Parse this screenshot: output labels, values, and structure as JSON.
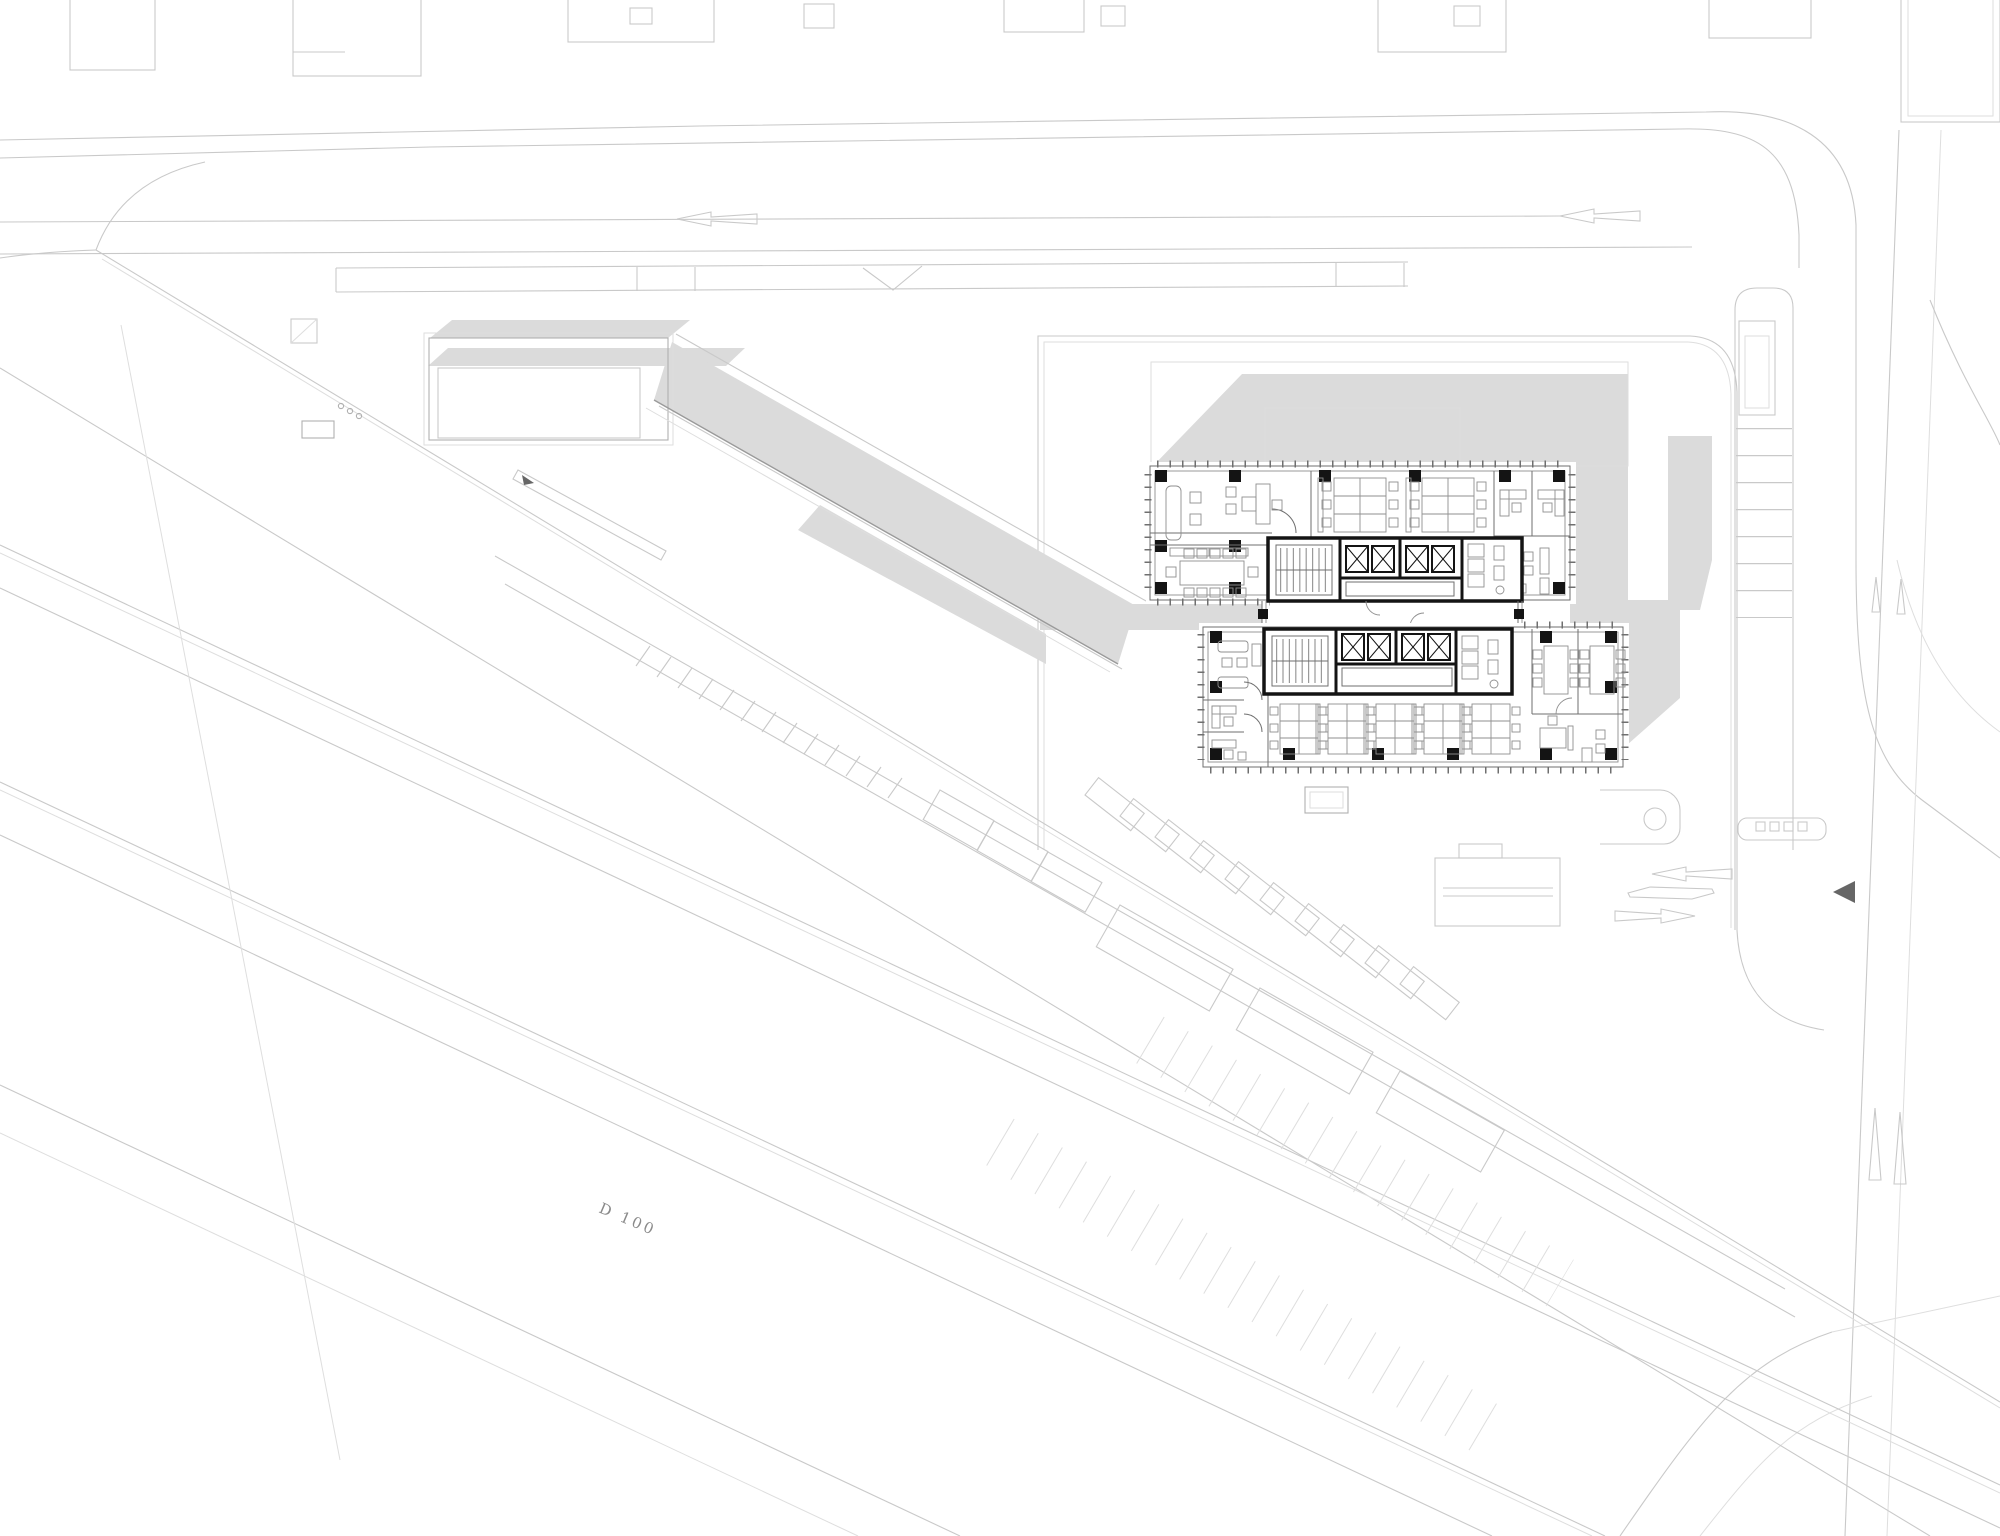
{
  "title": "architectural site plan with office floor plate",
  "labels": {
    "road_marking": "D 100"
  },
  "icons": {
    "west_arrow_left_lane": "outline-arrow-left",
    "east_arrow_left_lane": "outline-arrow-left",
    "merge_chevron": "v-chevron",
    "drop_off_arrow_in": "outline-arrow-left",
    "drop_off_arrow_out": "outline-arrow-right",
    "entry_marker": "filled-triangle-left",
    "crosswalk_arrows": "thin-double-arrows"
  },
  "colors": {
    "background": "#ffffff",
    "site_line": "#c9c9c9",
    "site_line_faint": "#dedede",
    "site_line_mid": "#b0b0b0",
    "paving": "#dbdbdb",
    "paving_dark_edge": "#9a9a9a",
    "wall": "#141414",
    "partition": "#6f6f6f",
    "furniture": "#8f8f8f",
    "marker": "#666666"
  }
}
